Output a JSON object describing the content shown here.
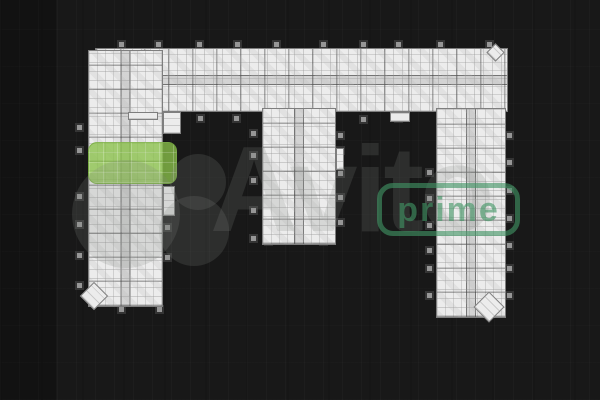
{
  "watermark": {
    "brand": "Avito",
    "badge": "prime"
  },
  "colors": {
    "background": "#181818",
    "plan_fill": "#ececec",
    "plan_wall": "#7e7e7e",
    "balcony_gray": "#969696",
    "highlight_green": "rgba(139,194,74,0.78)",
    "wm_gray": "rgba(130,135,130,0.20)",
    "prime_green": "rgba(64,148,100,0.62)"
  }
}
